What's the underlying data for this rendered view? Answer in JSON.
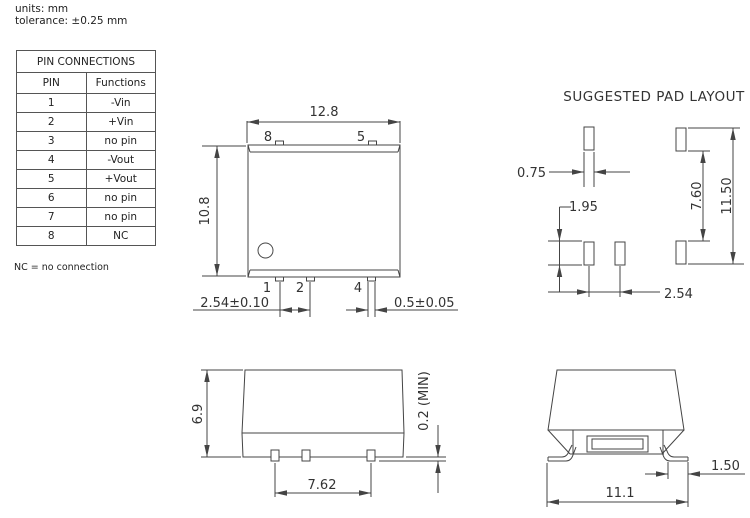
{
  "meta": {
    "units_label": "units: mm",
    "tolerance_label": "tolerance: ±0.25 mm",
    "nc_note": "NC = no connection"
  },
  "pin_table": {
    "title": "PIN CONNECTIONS",
    "col_pin": "PIN",
    "col_functions": "Functions",
    "rows": [
      {
        "pin": "1",
        "func": "-Vin"
      },
      {
        "pin": "2",
        "func": "+Vin"
      },
      {
        "pin": "3",
        "func": "no pin"
      },
      {
        "pin": "4",
        "func": "-Vout"
      },
      {
        "pin": "5",
        "func": "+Vout"
      },
      {
        "pin": "6",
        "func": "no pin"
      },
      {
        "pin": "7",
        "func": "no pin"
      },
      {
        "pin": "8",
        "func": "NC"
      }
    ]
  },
  "top_view": {
    "dim_width": "12.8",
    "dim_height": "10.8",
    "dim_pitch": "2.54±0.10",
    "dim_pin_width": "0.5±0.05",
    "pin_labels": {
      "p8": "8",
      "p5": "5",
      "p1": "1",
      "p2": "2",
      "p4": "4"
    }
  },
  "pad_layout": {
    "title": "SUGGESTED PAD LAYOUT",
    "dim_pad_width": "0.75",
    "dim_pad_height": "1.95",
    "dim_pitch": "2.54",
    "dim_inner_span": "7.60",
    "dim_outer_span": "11.50"
  },
  "side_view": {
    "dim_height": "6.9",
    "dim_pin_span": "7.62",
    "dim_standoff": "0.2 (MIN)"
  },
  "end_view": {
    "dim_lead": "1.50",
    "dim_width": "11.1"
  },
  "colors": {
    "line": "#444444",
    "text": "#333333",
    "background": "#ffffff"
  }
}
